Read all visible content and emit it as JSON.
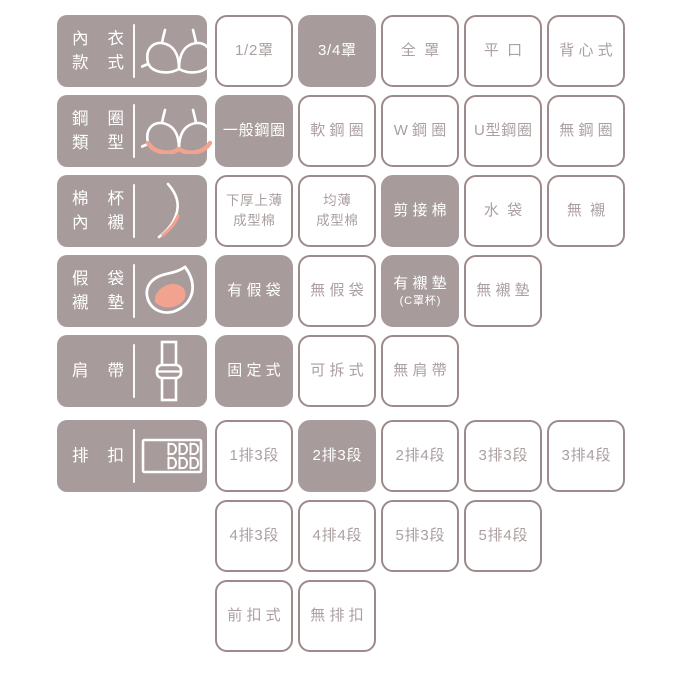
{
  "colors": {
    "mauve": "#a79b9c",
    "border": "#9d8a8a",
    "muted_text": "#ab9fa0",
    "pink": "#f2a38f",
    "white": "#ffffff"
  },
  "rows": [
    {
      "name": "bra-style",
      "icon": "bra",
      "label_lines": [
        "內衣",
        "款式"
      ],
      "options": [
        {
          "label": "1/2罩",
          "selected": false
        },
        {
          "label": "3/4罩",
          "selected": true
        },
        {
          "label": "全罩",
          "selected": false
        },
        {
          "label": "平口",
          "selected": false
        },
        {
          "label": "背心式",
          "selected": false
        }
      ]
    },
    {
      "name": "wire-type",
      "icon": "wire-bra",
      "label_lines": [
        "鋼圈",
        "類型"
      ],
      "options": [
        {
          "label": "一般鋼圈",
          "selected": true
        },
        {
          "label": "軟鋼圈",
          "selected": false
        },
        {
          "label": "W鋼圈",
          "selected": false
        },
        {
          "label": "U型鋼圈",
          "selected": false
        },
        {
          "label": "無鋼圈",
          "selected": false
        }
      ]
    },
    {
      "name": "cup-lining",
      "icon": "cup",
      "label_lines": [
        "棉杯",
        "內襯"
      ],
      "options": [
        {
          "lines": [
            "下厚上薄",
            "成型棉"
          ],
          "selected": false
        },
        {
          "lines": [
            "均薄",
            "成型棉"
          ],
          "selected": false
        },
        {
          "label": "剪接棉",
          "selected": true
        },
        {
          "label": "水袋",
          "selected": false
        },
        {
          "label": "無襯",
          "selected": false
        }
      ]
    },
    {
      "name": "pad-pocket",
      "icon": "pad",
      "label_lines": [
        "假袋",
        "襯墊"
      ],
      "options": [
        {
          "label": "有假袋",
          "selected": true
        },
        {
          "label": "無假袋",
          "selected": false
        },
        {
          "label": "有襯墊",
          "sub": "(C罩杯)",
          "selected": true
        },
        {
          "label": "無襯墊",
          "selected": false
        }
      ]
    },
    {
      "name": "strap",
      "icon": "strap",
      "label_lines": [
        "肩帶"
      ],
      "options": [
        {
          "label": "固定式",
          "selected": true
        },
        {
          "label": "可拆式",
          "selected": false
        },
        {
          "label": "無肩帶",
          "selected": false
        }
      ]
    },
    {
      "name": "hooks",
      "icon": "hooks",
      "label_lines": [
        "排扣"
      ],
      "options": [
        {
          "label": "1排3段",
          "selected": false
        },
        {
          "label": "2排3段",
          "selected": true
        },
        {
          "label": "2排4段",
          "selected": false
        },
        {
          "label": "3排3段",
          "selected": false
        },
        {
          "label": "3排4段",
          "selected": false
        }
      ]
    },
    {
      "name": "hooks-row2",
      "options": [
        {
          "label": "4排3段",
          "selected": false
        },
        {
          "label": "4排4段",
          "selected": false
        },
        {
          "label": "5排3段",
          "selected": false
        },
        {
          "label": "5排4段",
          "selected": false
        }
      ]
    },
    {
      "name": "hooks-row3",
      "options": [
        {
          "label": "前扣式",
          "selected": false
        },
        {
          "label": "無排扣",
          "selected": false
        }
      ]
    }
  ]
}
